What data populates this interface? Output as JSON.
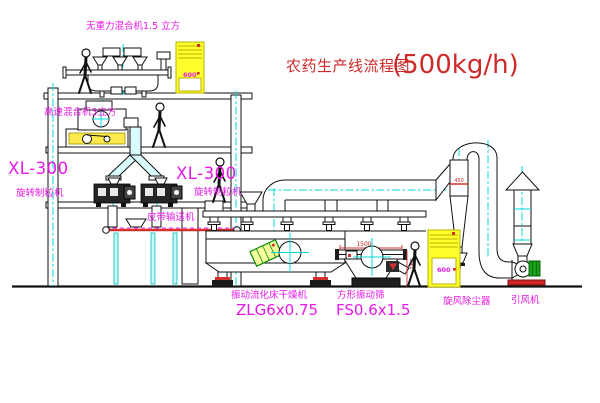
{
  "title": {
    "text_cn": "农药生产线流程图",
    "capacity": "(500kg/h)"
  },
  "labels": {
    "gravity_mixer": "无重力混合机1.5 立方",
    "high_speed_mixer": "高速混合机3立方",
    "granulator_left_model": "XL-300",
    "granulator_left_name": "旋转制粒机",
    "granulator_right_model": "XL-300",
    "granulator_right_name": "旋转制粒机",
    "belt_conveyor": "皮带输送机",
    "dryer_name": "振动流化床干燥机",
    "dryer_model": "ZLG6x0.75",
    "sieve_name": "方形振动筛",
    "sieve_model": "FS0.6x1.5",
    "cyclone": "旋风除尘器",
    "fan": "引风机"
  },
  "dimensions": {
    "sieve_width": "1500",
    "sieve_base_height": "341",
    "cyclone": "450"
  },
  "cabinet_displays": {
    "top": "600",
    "bottom": "600"
  },
  "colors": {
    "label_magenta": "#e818e8",
    "title_red": "#cf2a2a",
    "centerline_cyan": "#00d8d8",
    "cabinet_yellow": "#ffff2e",
    "motor_green": "#18a018",
    "accent_red": "#d43030",
    "line_black": "#111111"
  }
}
